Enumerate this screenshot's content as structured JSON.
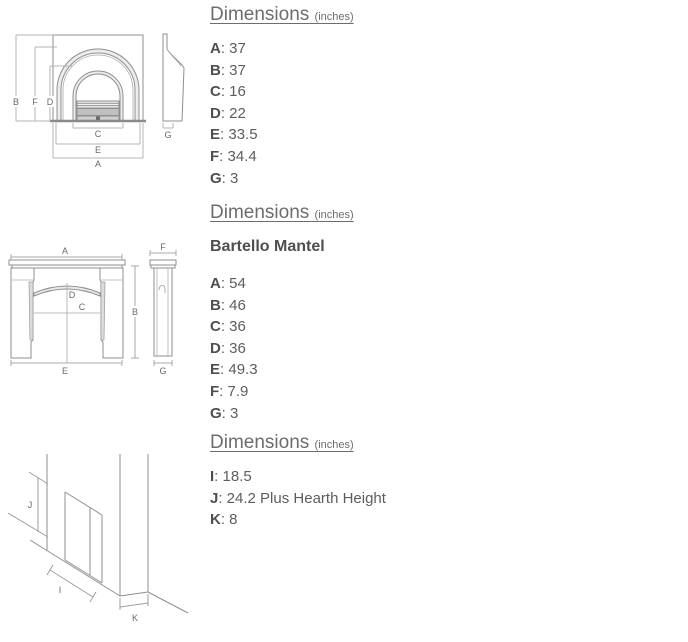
{
  "ui": {
    "separator": ": "
  },
  "sections": [
    {
      "heading": {
        "title": "Dimensions",
        "unit": "(inches)"
      },
      "items": [
        {
          "label": "A",
          "value": "37"
        },
        {
          "label": "B",
          "value": "37"
        },
        {
          "label": "C",
          "value": "16"
        },
        {
          "label": "D",
          "value": "22"
        },
        {
          "label": "E",
          "value": "33.5"
        },
        {
          "label": "F",
          "value": "34.4"
        },
        {
          "label": "G",
          "value": "3"
        }
      ]
    },
    {
      "heading": {
        "title": "Dimensions",
        "unit": "(inches)"
      },
      "subtitle": "Bartello Mantel",
      "items": [
        {
          "label": "A",
          "value": "54"
        },
        {
          "label": "B",
          "value": "46"
        },
        {
          "label": "C",
          "value": "36"
        },
        {
          "label": "D",
          "value": "36"
        },
        {
          "label": "E",
          "value": "49.3"
        },
        {
          "label": "F",
          "value": "7.9"
        },
        {
          "label": "G",
          "value": "3"
        }
      ]
    },
    {
      "heading": {
        "title": "Dimensions",
        "unit": "(inches)"
      },
      "items": [
        {
          "label": "I",
          "value": "18.5"
        },
        {
          "label": "J",
          "value": "24.2 Plus Hearth Height"
        },
        {
          "label": "K",
          "value": "8"
        }
      ]
    }
  ],
  "drawings": {
    "insert": {
      "labels": {
        "A": "A",
        "B": "B",
        "C": "C",
        "D": "D",
        "E": "E",
        "F": "F",
        "G": "G"
      }
    },
    "mantel": {
      "labels": {
        "A": "A",
        "B": "B",
        "C": "C",
        "D": "D",
        "E": "E",
        "F": "F",
        "G": "G"
      }
    },
    "hearth": {
      "labels": {
        "I": "I",
        "J": "J",
        "K": "K"
      }
    }
  },
  "colors": {
    "heading_text": "#6d6d6d",
    "body_text": "#5d5d5d",
    "bold_text": "#4f4f4f",
    "drawing_line": "#8f8f8f",
    "dimension_line": "#b4b4b4",
    "shade_fill": "#ececec"
  }
}
